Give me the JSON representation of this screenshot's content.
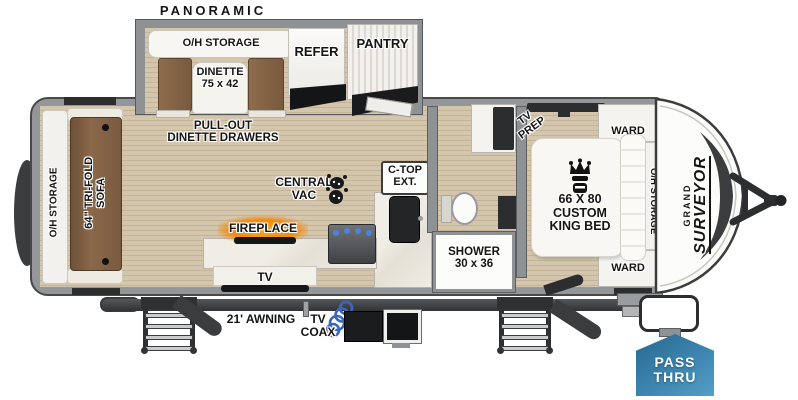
{
  "title": "PANORAMIC WINDOW",
  "slide": {
    "oh_storage": "O/H STORAGE",
    "dinette1": "DINETTE",
    "dinette2": "75 x 42",
    "refer": "REFER",
    "pantry": "PANTRY"
  },
  "living": {
    "pullout1": "PULL-OUT",
    "pullout2": "DINETTE DRAWERS",
    "oh_storage": "O/H STORAGE",
    "sofa1": "64\" TRI-FOLD",
    "sofa2": "SOFA",
    "central1": "CENTRAL",
    "central2": "VAC",
    "ctop1": "C-TOP",
    "ctop2": "EXT.",
    "fireplace": "FIREPLACE",
    "tv": "TV"
  },
  "bath": {
    "shower1": "SHOWER",
    "shower2": "30 x 36"
  },
  "bedroom": {
    "tvprep1": "TV",
    "tvprep2": "PREP",
    "ward_top": "WARD",
    "ward_bottom": "WARD",
    "bed1": "66 X 80",
    "bed2": "CUSTOM",
    "bed3": "KING BED",
    "oh_storage": "O/H STORAGE"
  },
  "exterior": {
    "awning": "21' AWNING",
    "coax1": "TV",
    "coax2": "COAX",
    "pass1": "PASS",
    "pass2": "THRU",
    "brand1": "GRAND",
    "brand2": "SURVEYOR"
  },
  "icons": {
    "bed_crown": "crown-icon",
    "central_vac": "central-vac-icon",
    "tv_coax": "coax-cable-icon"
  },
  "colors": {
    "pass_thru_blue": "#3d85b0",
    "awning_dark": "#3a3c3e",
    "floor_tan": "#cfc1a8",
    "wall_gray": "#8f9295",
    "sofa_brown": "#7f6147",
    "fireplace_orange": "#f5921c",
    "coax_blue": "#3b66c0"
  }
}
